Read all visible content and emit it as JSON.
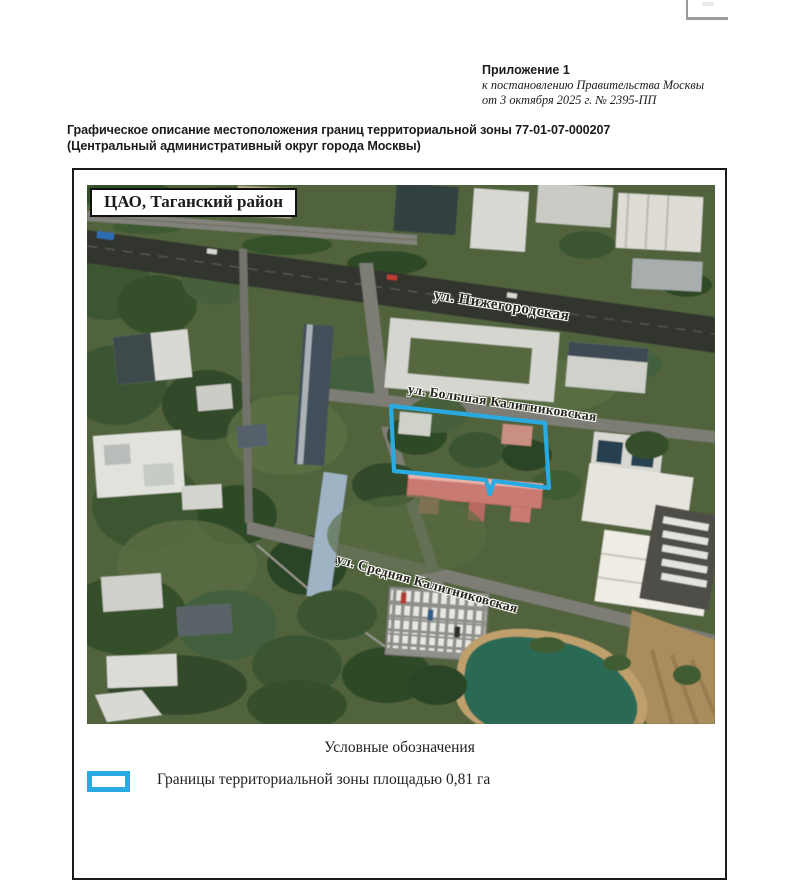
{
  "header": {
    "appendix": "Приложение 1",
    "line1": "к постановлению Правительства Москвы",
    "line2": "от 3 октября 2025 г. № 2395-ПП"
  },
  "doc_title": {
    "line1": "Графическое описание местоположения границ территориальной зоны 77-01-07-000207",
    "line2": "(Центральный административный округ города Москвы)"
  },
  "map": {
    "region_label": "ЦАО, Таганский район",
    "streets": [
      "ул. Нижегородская",
      "ул. Большая Калитниковская",
      "ул. Средняя Калитниковская"
    ],
    "zone_color": "#29ABE2"
  },
  "legend": {
    "title": "Условные обозначения",
    "item": "Границы территориальной зоны площадью 0,81 га"
  }
}
